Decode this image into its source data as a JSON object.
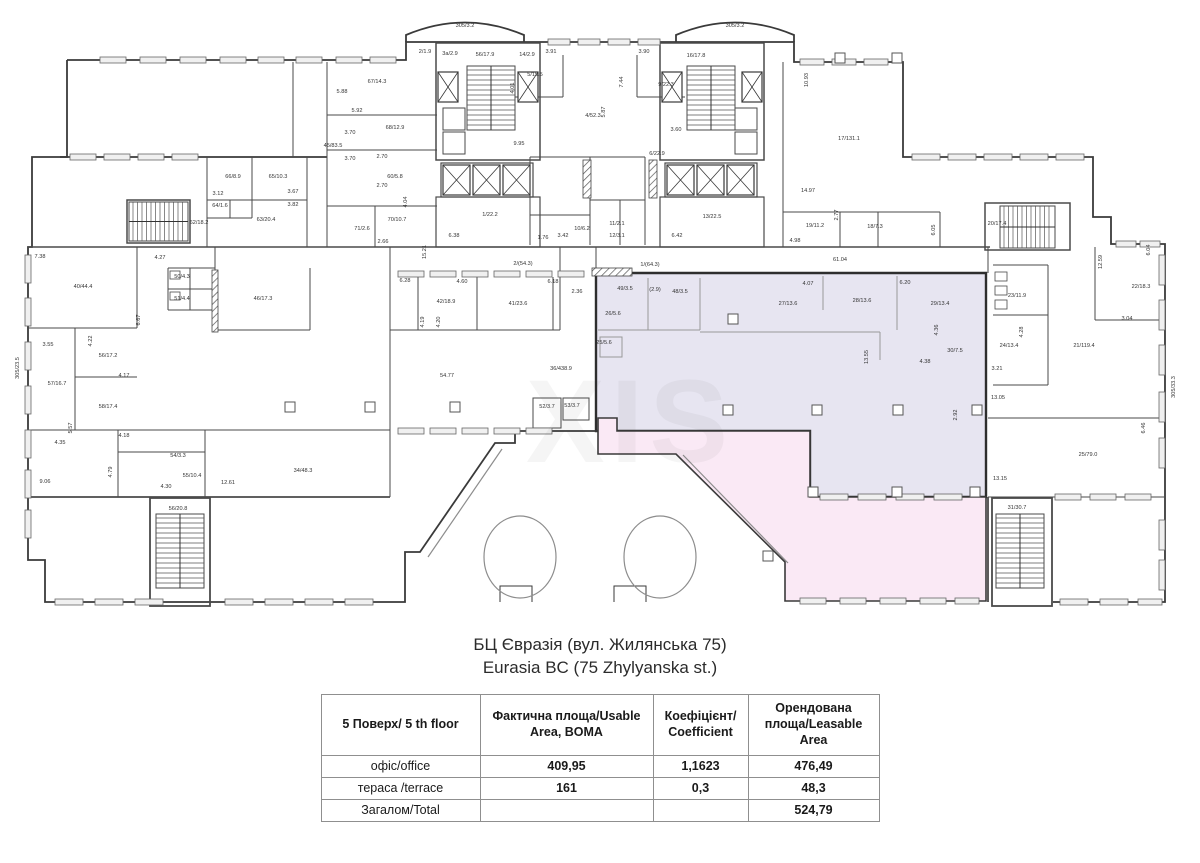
{
  "header": {
    "title_uk": "БЦ Євразія (вул. Жилянська 75)",
    "title_en": "Eurasia BC (75 Zhylyanska st.)"
  },
  "table": {
    "columns": [
      "5 Поверх/ 5 th floor",
      "Фактична площа/Usable Area, BOMA",
      "Коефіцієнт/ Coefficient",
      "Орендована площа/Leasable Area"
    ],
    "rows": [
      {
        "label": "офіс/office",
        "usable": "409,95",
        "coefficient": "1,1623",
        "leasable": "476,49"
      },
      {
        "label": "тераса /terrace",
        "usable": "161",
        "coefficient": "0,3",
        "leasable": "48,3"
      },
      {
        "label": "Загалом/Total",
        "usable": "",
        "coefficient": "",
        "leasable": "524,79"
      }
    ]
  },
  "plan": {
    "colors": {
      "office_fill": "#e7e5f1",
      "terrace_fill": "#fae9f5",
      "wall": "#3a3a3a"
    },
    "watermark": "XIS",
    "labels": [
      {
        "x": 465,
        "y": 27,
        "t": "305/3.2"
      },
      {
        "x": 735,
        "y": 27,
        "t": "305/3.2"
      },
      {
        "x": 425,
        "y": 53,
        "t": "2/1.9"
      },
      {
        "x": 450,
        "y": 55,
        "t": "3a/2.9"
      },
      {
        "x": 485,
        "y": 56,
        "t": "56/17.9"
      },
      {
        "x": 527,
        "y": 56,
        "t": "14/2.9"
      },
      {
        "x": 551,
        "y": 53,
        "t": "3.91"
      },
      {
        "x": 535,
        "y": 76,
        "t": "5/15.5"
      },
      {
        "x": 514,
        "y": 88,
        "t": "4.01",
        "r": 1
      },
      {
        "x": 519,
        "y": 145,
        "t": "9.95"
      },
      {
        "x": 593,
        "y": 117,
        "t": "4/52.3"
      },
      {
        "x": 644,
        "y": 53,
        "t": "3.90"
      },
      {
        "x": 623,
        "y": 82,
        "t": "7.44",
        "r": 1
      },
      {
        "x": 666,
        "y": 86,
        "t": "9/22.3"
      },
      {
        "x": 605,
        "y": 112,
        "t": "5.87",
        "r": 1
      },
      {
        "x": 676,
        "y": 131,
        "t": "3.60"
      },
      {
        "x": 657,
        "y": 155,
        "t": "6/22.9"
      },
      {
        "x": 696,
        "y": 57,
        "t": "16/17.8"
      },
      {
        "x": 342,
        "y": 93,
        "t": "5.88"
      },
      {
        "x": 357,
        "y": 112,
        "t": "5.92"
      },
      {
        "x": 350,
        "y": 134,
        "t": "3.70"
      },
      {
        "x": 350,
        "y": 160,
        "t": "3.70"
      },
      {
        "x": 377,
        "y": 83,
        "t": "67/14.3"
      },
      {
        "x": 395,
        "y": 129,
        "t": "68/12.9"
      },
      {
        "x": 333,
        "y": 147,
        "t": "45/83.5"
      },
      {
        "x": 395,
        "y": 178,
        "t": "60/5.8"
      },
      {
        "x": 397,
        "y": 221,
        "t": "70/10.7"
      },
      {
        "x": 362,
        "y": 230,
        "t": "71/2.6"
      },
      {
        "x": 383,
        "y": 243,
        "t": "2.66"
      },
      {
        "x": 407,
        "y": 202,
        "t": "4.04",
        "r": 1
      },
      {
        "x": 382,
        "y": 158,
        "t": "2.70"
      },
      {
        "x": 382,
        "y": 187,
        "t": "2.70"
      },
      {
        "x": 218,
        "y": 195,
        "t": "3.12"
      },
      {
        "x": 293,
        "y": 193,
        "t": "3.67"
      },
      {
        "x": 293,
        "y": 206,
        "t": "3.82"
      },
      {
        "x": 233,
        "y": 178,
        "t": "66/8.9"
      },
      {
        "x": 278,
        "y": 178,
        "t": "65/10.3"
      },
      {
        "x": 266,
        "y": 221,
        "t": "63/20.4"
      },
      {
        "x": 220,
        "y": 207,
        "t": "64/1.6"
      },
      {
        "x": 199,
        "y": 224,
        "t": "62/18.2"
      },
      {
        "x": 808,
        "y": 80,
        "t": "10.93",
        "r": 1
      },
      {
        "x": 849,
        "y": 140,
        "t": "17/131.1"
      },
      {
        "x": 808,
        "y": 192,
        "t": "14.97"
      },
      {
        "x": 815,
        "y": 227,
        "t": "19/11.2"
      },
      {
        "x": 875,
        "y": 228,
        "t": "18/7.3"
      },
      {
        "x": 838,
        "y": 215,
        "t": "2.77",
        "r": 1
      },
      {
        "x": 795,
        "y": 242,
        "t": "4.98"
      },
      {
        "x": 935,
        "y": 230,
        "t": "6.05",
        "r": 1
      },
      {
        "x": 997,
        "y": 225,
        "t": "20/17.4"
      },
      {
        "x": 490,
        "y": 216,
        "t": "1/22.2"
      },
      {
        "x": 454,
        "y": 237,
        "t": "6.38"
      },
      {
        "x": 677,
        "y": 237,
        "t": "6.42"
      },
      {
        "x": 712,
        "y": 218,
        "t": "13/22.5"
      },
      {
        "x": 582,
        "y": 230,
        "t": "10/6.2"
      },
      {
        "x": 563,
        "y": 237,
        "t": "3.42"
      },
      {
        "x": 543,
        "y": 239,
        "t": "1.76"
      },
      {
        "x": 617,
        "y": 225,
        "t": "11/2.1"
      },
      {
        "x": 617,
        "y": 237,
        "t": "12/3.1"
      },
      {
        "x": 426,
        "y": 252,
        "t": "15.21",
        "r": 1
      },
      {
        "x": 840,
        "y": 261,
        "t": "61.04"
      },
      {
        "x": 650,
        "y": 266,
        "t": "1/(64.3)"
      },
      {
        "x": 523,
        "y": 265,
        "t": "2/(54.3)"
      },
      {
        "x": 405,
        "y": 282,
        "t": "6.28"
      },
      {
        "x": 462,
        "y": 283,
        "t": "4.60"
      },
      {
        "x": 553,
        "y": 283,
        "t": "6.18"
      },
      {
        "x": 577,
        "y": 293,
        "t": "2.36"
      },
      {
        "x": 446,
        "y": 303,
        "t": "42/18.9"
      },
      {
        "x": 518,
        "y": 305,
        "t": "41/23.6"
      },
      {
        "x": 424,
        "y": 322,
        "t": "4.19",
        "r": 1
      },
      {
        "x": 440,
        "y": 322,
        "t": "4.20",
        "r": 1
      },
      {
        "x": 447,
        "y": 377,
        "t": "54.77"
      },
      {
        "x": 561,
        "y": 370,
        "t": "36/438.9"
      },
      {
        "x": 40,
        "y": 258,
        "t": "7.38"
      },
      {
        "x": 160,
        "y": 259,
        "t": "4.27"
      },
      {
        "x": 83,
        "y": 288,
        "t": "40/44.4"
      },
      {
        "x": 182,
        "y": 278,
        "t": "50/4.3"
      },
      {
        "x": 182,
        "y": 300,
        "t": "51/4.4"
      },
      {
        "x": 140,
        "y": 320,
        "t": "6.67",
        "r": 1
      },
      {
        "x": 48,
        "y": 346,
        "t": "3.55"
      },
      {
        "x": 92,
        "y": 341,
        "t": "4.22",
        "r": 1
      },
      {
        "x": 108,
        "y": 357,
        "t": "56/17.2"
      },
      {
        "x": 124,
        "y": 377,
        "t": "4.17"
      },
      {
        "x": 57,
        "y": 385,
        "t": "57/16.7"
      },
      {
        "x": 108,
        "y": 408,
        "t": "58/17.4"
      },
      {
        "x": 124,
        "y": 437,
        "t": "4.18"
      },
      {
        "x": 72,
        "y": 428,
        "t": "5.57",
        "r": 1
      },
      {
        "x": 45,
        "y": 483,
        "t": "9.06"
      },
      {
        "x": 112,
        "y": 472,
        "t": "4.79",
        "r": 1
      },
      {
        "x": 19,
        "y": 368,
        "t": "305/23.5",
        "r": 1
      },
      {
        "x": 60,
        "y": 444,
        "t": "4.35"
      },
      {
        "x": 263,
        "y": 300,
        "t": "46/17.3"
      },
      {
        "x": 166,
        "y": 488,
        "t": "4.30"
      },
      {
        "x": 228,
        "y": 484,
        "t": "12.61"
      },
      {
        "x": 178,
        "y": 457,
        "t": "54/3.3"
      },
      {
        "x": 192,
        "y": 477,
        "t": "55/10.4"
      },
      {
        "x": 303,
        "y": 472,
        "t": "34/48.3"
      },
      {
        "x": 178,
        "y": 510,
        "t": "56/20.8"
      },
      {
        "x": 625,
        "y": 290,
        "t": "49/3.5"
      },
      {
        "x": 655,
        "y": 291,
        "t": "(2.9)"
      },
      {
        "x": 680,
        "y": 293,
        "t": "48/3.5"
      },
      {
        "x": 613,
        "y": 315,
        "t": "26/5.6"
      },
      {
        "x": 604,
        "y": 344,
        "t": "25/5.6"
      },
      {
        "x": 788,
        "y": 305,
        "t": "27/13.6"
      },
      {
        "x": 862,
        "y": 302,
        "t": "28/13.6"
      },
      {
        "x": 940,
        "y": 305,
        "t": "29/13.4"
      },
      {
        "x": 808,
        "y": 285,
        "t": "4.07"
      },
      {
        "x": 905,
        "y": 284,
        "t": "6.20"
      },
      {
        "x": 868,
        "y": 357,
        "t": "13.55",
        "r": 1
      },
      {
        "x": 925,
        "y": 363,
        "t": "4.38"
      },
      {
        "x": 955,
        "y": 352,
        "t": "30/7.5"
      },
      {
        "x": 938,
        "y": 330,
        "t": "4.36",
        "r": 1
      },
      {
        "x": 957,
        "y": 415,
        "t": "2.92",
        "r": 1
      },
      {
        "x": 547,
        "y": 408,
        "t": "52/3.7"
      },
      {
        "x": 572,
        "y": 407,
        "t": "53/3.7"
      },
      {
        "x": 1141,
        "y": 288,
        "t": "22/18.3"
      },
      {
        "x": 1102,
        "y": 262,
        "t": "12.59",
        "r": 1
      },
      {
        "x": 1150,
        "y": 250,
        "t": "6.04",
        "r": 1
      },
      {
        "x": 1127,
        "y": 320,
        "t": "3.04"
      },
      {
        "x": 1084,
        "y": 347,
        "t": "21/119.4"
      },
      {
        "x": 1009,
        "y": 347,
        "t": "24/13.4"
      },
      {
        "x": 1023,
        "y": 332,
        "t": "4.28",
        "r": 1
      },
      {
        "x": 997,
        "y": 370,
        "t": "3.21"
      },
      {
        "x": 998,
        "y": 399,
        "t": "13.05"
      },
      {
        "x": 1175,
        "y": 387,
        "t": "305/33.3",
        "r": 1
      },
      {
        "x": 1088,
        "y": 456,
        "t": "25/79.0"
      },
      {
        "x": 1145,
        "y": 428,
        "t": "6.46",
        "r": 1
      },
      {
        "x": 1000,
        "y": 480,
        "t": "13.15"
      },
      {
        "x": 1017,
        "y": 297,
        "t": "23/11.9"
      },
      {
        "x": 1017,
        "y": 509,
        "t": "31/30.7"
      }
    ]
  }
}
